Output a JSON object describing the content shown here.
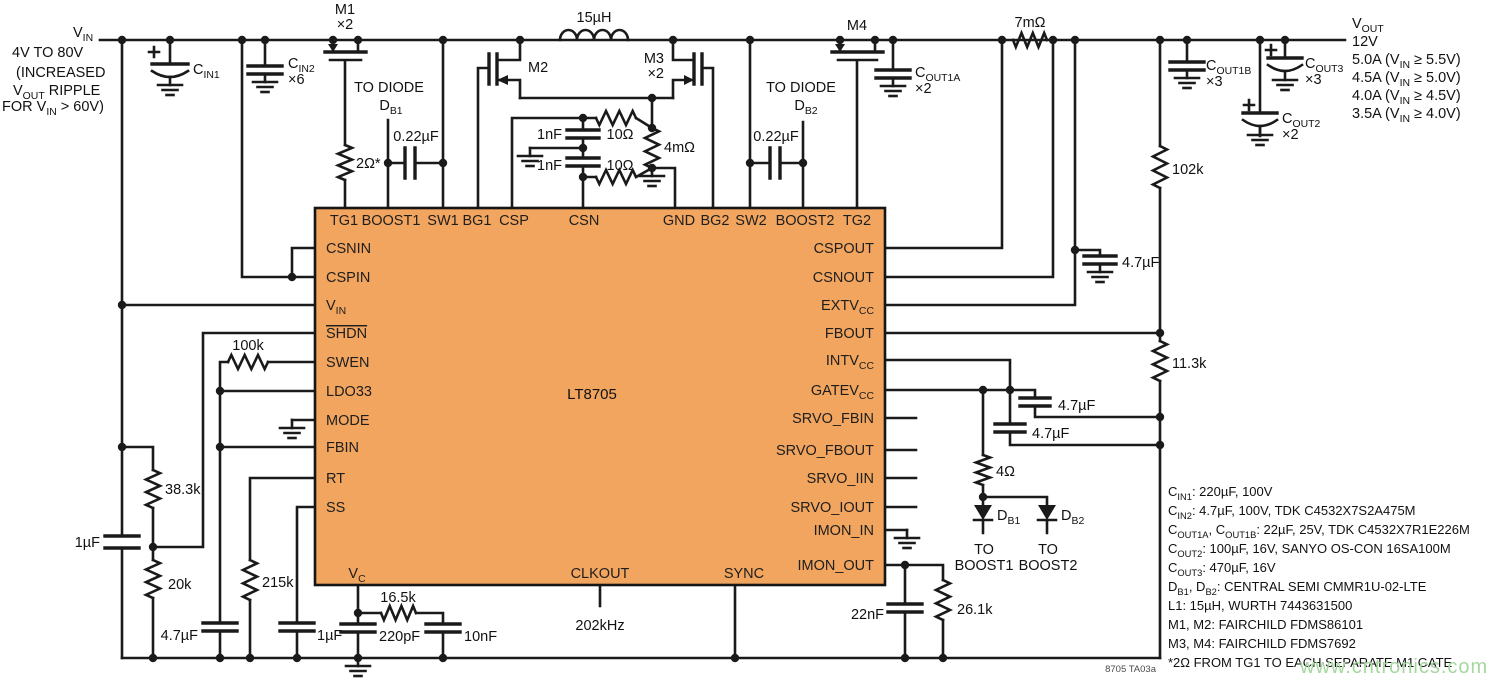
{
  "colors": {
    "ic_fill": "#F2A55E",
    "wire": "#1a1a1a",
    "watermark_green": "#a6d7a0",
    "footnote_gray": "#4a4a4a"
  },
  "ic": {
    "part": "LT8705",
    "pins": {
      "top": [
        "TG1",
        "BOOST1",
        "SW1",
        "BG1",
        "CSP",
        "CSN",
        "GND",
        "BG2",
        "SW2",
        "BOOST2",
        "TG2"
      ],
      "left": [
        "CSNIN",
        "CSPIN",
        [
          {
            "t": "V"
          },
          {
            "s": "IN"
          }
        ],
        [
          {
            "o": "SHDN"
          }
        ],
        "SWEN",
        "LDO33",
        "MODE",
        "FBIN",
        "RT",
        "SS"
      ],
      "right": [
        "CSPOUT",
        "CSNOUT",
        [
          {
            "t": "EXTV"
          },
          {
            "s": "CC"
          }
        ],
        "FBOUT",
        [
          {
            "t": "INTV"
          },
          {
            "s": "CC"
          }
        ],
        [
          {
            "t": "GATEV"
          },
          {
            "s": "CC"
          }
        ],
        "SRVO_FBIN",
        "SRVO_FBOUT",
        "SRVO_IIN",
        "SRVO_IOUT",
        "IMON_IN",
        "IMON_OUT"
      ],
      "bottom": [
        [
          {
            "t": "V"
          },
          {
            "s": "C"
          }
        ],
        "CLKOUT",
        "SYNC"
      ]
    }
  },
  "input": {
    "vin": [
      {
        "t": "V"
      },
      {
        "s": "IN"
      }
    ],
    "range": "4V TO 80V",
    "note1": "(INCREASED",
    "note2": [
      {
        "t": "V"
      },
      {
        "s": "OUT"
      },
      {
        "t": " RIPPLE"
      }
    ],
    "note3": [
      {
        "t": "FOR V"
      },
      {
        "s": "IN"
      },
      {
        "t": " > 60V)"
      }
    ]
  },
  "output": {
    "vout": [
      {
        "t": "V"
      },
      {
        "s": "OUT"
      }
    ],
    "voltage": "12V",
    "ratings": [
      [
        {
          "t": "5.0A (V"
        },
        {
          "s": "IN"
        },
        {
          "t": " ≥ 5.5V)"
        }
      ],
      [
        {
          "t": "4.5A (V"
        },
        {
          "s": "IN"
        },
        {
          "t": " ≥ 5.0V)"
        }
      ],
      [
        {
          "t": "4.0A (V"
        },
        {
          "s": "IN"
        },
        {
          "t": " ≥ 4.5V)"
        }
      ],
      [
        {
          "t": "3.5A (V"
        },
        {
          "s": "IN"
        },
        {
          "t": " ≥ 4.0V)"
        }
      ]
    ]
  },
  "components": {
    "cin1": [
      {
        "t": "C"
      },
      {
        "s": "IN1"
      }
    ],
    "cin2": [
      {
        "t": "C"
      },
      {
        "s": "IN2"
      }
    ],
    "cin2_qty": "×6",
    "m1": "M1",
    "m1_qty": "×2",
    "r_tg1": "2Ω*",
    "to_diode_b1": "TO DIODE",
    "d_b1": [
      {
        "t": "D"
      },
      {
        "s": "B1"
      }
    ],
    "c_boost1": "0.22µF",
    "l1": "15µH",
    "m2": "M2",
    "m3": "M3",
    "m3_qty": "×2",
    "c_csp": "1nF",
    "c_csn": "1nF",
    "r_csp": "10Ω",
    "r_csn": "10Ω",
    "r_sense_in": "4mΩ",
    "to_diode_b2": "TO DIODE",
    "d_b2": [
      {
        "t": "D"
      },
      {
        "s": "B2"
      }
    ],
    "c_boost2": "0.22µF",
    "m4": "M4",
    "cout1a": [
      {
        "t": "C"
      },
      {
        "s": "OUT1A"
      }
    ],
    "cout1a_qty": "×2",
    "r_sense_out": "7mΩ",
    "r_fb_top": "102k",
    "cout1b": [
      {
        "t": "C"
      },
      {
        "s": "OUT1B"
      }
    ],
    "cout1b_qty": "×3",
    "cout3": [
      {
        "t": "C"
      },
      {
        "s": "OUT3"
      }
    ],
    "cout3_qty": "×3",
    "cout2": [
      {
        "t": "C"
      },
      {
        "s": "OUT2"
      }
    ],
    "cout2_qty": "×2",
    "r_swen": "100k",
    "r_div_top": "38.3k",
    "r_div_bot": "20k",
    "c_vin_bypass": "1µF",
    "c_fbin": "4.7µF",
    "r_rt": "215k",
    "c_ss": "1µF",
    "r_vc": "16.5k",
    "c_vc": "220pF",
    "c_vc2": "10nF",
    "clkout_freq": "202kHz",
    "c_extvcc": "4.7µF",
    "r_fb_bot": "11.3k",
    "c_intvcc": "4.7µF",
    "c_gatevcc": "4.7µF",
    "r_boost": "4Ω",
    "to_boost1_l1": "TO",
    "to_boost1_l2": "BOOST1",
    "to_boost2_l1": "TO",
    "to_boost2_l2": "BOOST2",
    "c_imon": "22nF",
    "r_imon": "26.1k"
  },
  "notes": {
    "lines": [
      [
        {
          "t": "C"
        },
        {
          "s": "IN1"
        },
        {
          "t": ": 220µF, 100V"
        }
      ],
      [
        {
          "t": "C"
        },
        {
          "s": "IN2"
        },
        {
          "t": ": 4.7µF, 100V, TDK C4532X7S2A475M"
        }
      ],
      [
        {
          "t": "C"
        },
        {
          "s": "OUT1A"
        },
        {
          "t": ", C"
        },
        {
          "s": "OUT1B"
        },
        {
          "t": ": 22µF, 25V, TDK C4532X7R1E226M"
        }
      ],
      [
        {
          "t": "C"
        },
        {
          "s": "OUT2"
        },
        {
          "t": ": 100µF, 16V, SANYO OS-CON 16SA100M"
        }
      ],
      [
        {
          "t": "C"
        },
        {
          "s": "OUT3"
        },
        {
          "t": ": 470µF, 16V"
        }
      ],
      [
        {
          "t": "D"
        },
        {
          "s": "B1"
        },
        {
          "t": ", D"
        },
        {
          "s": "B2"
        },
        {
          "t": ": CENTRAL SEMI CMMR1U-02-LTE"
        }
      ],
      [
        {
          "t": "L1: 15µH, WURTH 7443631500"
        }
      ],
      [
        {
          "t": "M1, M2: FAIRCHILD FDMS86101"
        }
      ],
      [
        {
          "t": "M3, M4: FAIRCHILD FDMS7692"
        }
      ],
      [
        {
          "t": "*2Ω FROM TG1 TO EACH SEPARATE M1 GATE"
        }
      ]
    ],
    "code": "8705 TA03a"
  },
  "watermark": "www.cntronics.com"
}
